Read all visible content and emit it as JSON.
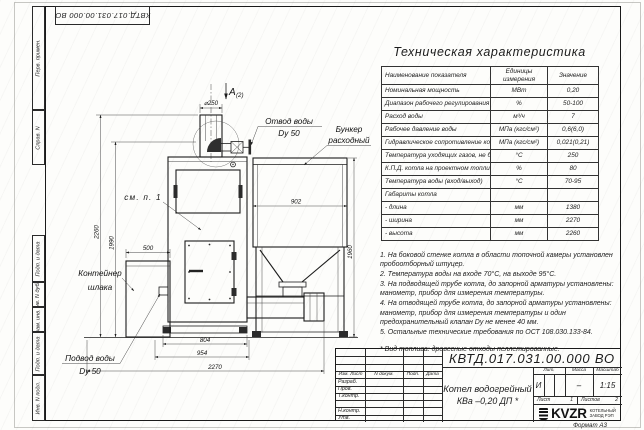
{
  "sheet": {
    "doc_number": "КВТД.017.031.00.000  ВО",
    "format_label": "Формат А3"
  },
  "margin_labels": [
    "Перв. примен.",
    "Справ. N",
    "Подп. и дата",
    "Инв. N дубл.",
    "Взам. инв. N",
    "Подп. и дата",
    "Инв. N подл."
  ],
  "spec_table": {
    "title": "Техническая характеристика",
    "col_name": "Наименование показателя",
    "col_units": "Единицы измерения",
    "col_value": "Значение",
    "rows": [
      {
        "name": "Номинальная мощность",
        "units": "МВт",
        "value": "0,20"
      },
      {
        "name": "Диапазон рабочего регулирования",
        "units": "%",
        "value": "50-100"
      },
      {
        "name": "Расход воды",
        "units": "м³/ч",
        "value": "7"
      },
      {
        "name": "Рабочее давление воды",
        "units": "МПа (кгс/см²)",
        "value": "0,6(6,0)"
      },
      {
        "name": "Гидравлическое сопротивление котла",
        "units": "МПа (кгс/см²)",
        "value": "0,021(0,21)"
      },
      {
        "name": "Температура уходящих газов, не более",
        "units": "°С",
        "value": "250"
      },
      {
        "name": "К.П.Д. котла на проектном топливе",
        "units": "%",
        "value": "80"
      },
      {
        "name": "Температура воды (вход/выход)",
        "units": "°С",
        "value": "70-95"
      },
      {
        "name": "Габариты котла",
        "units": "",
        "value": ""
      },
      {
        "name": "- длина",
        "units": "мм",
        "value": "1380"
      },
      {
        "name": "- ширина",
        "units": "мм",
        "value": "2270"
      },
      {
        "name": "- высота",
        "units": "мм",
        "value": "2260"
      }
    ]
  },
  "notes": {
    "items": [
      "1. На боковой стенке котла в области топочной камеры установлен пробоотборный штуцер.",
      "2. Температура воды на входе 70°С, на выходе 95°С.",
      "3. На подводящей трубе котла, до запорной арматуры установлены: манометр, прибор для измерения температуры.",
      "4. На отводящей трубе котла, до запорной арматуры установлены: манометр, прибор для измерения температуры и один предохранительный клапан Dу не менее 40 мм.",
      "5. Остальные технические требования по ОСТ 108.030.133-84."
    ],
    "fuel_note": "* Вид топлива: древесные отходы пеллетированные."
  },
  "title_block": {
    "doc_number": "КВТД.017.031.00.000  ВО",
    "product_line1": "Котел водогрейный",
    "product_line2": "КВа –0,20  ДП *",
    "col_izm": "Изм. Лист",
    "col_doc": "N докум.",
    "col_sign": "Подп.",
    "col_date": "Дата",
    "row_razrab": "Разраб.",
    "row_prov": "Пров.",
    "row_tkontr": "Т.контр.",
    "row_nkontr": "Н.контр.",
    "row_utv": "Утв.",
    "lit_label": "Лит.",
    "mass_label": "Масса",
    "scale_label": "Масштаб",
    "lit_value": "И",
    "mass_value": "–",
    "scale_value": "1:15",
    "sheet_label": "Лист",
    "sheet_value": "1",
    "sheets_label": "Листов",
    "sheets_value": "2",
    "company_name": "KVZR",
    "company_sub1": "КОТЕЛЬНЫЙ",
    "company_sub2": "ЗАВОД РЭП"
  },
  "drawing": {
    "view_label": "А",
    "view_sub": "(2)",
    "dia": "⌀250",
    "dim_500": "500",
    "dim_902": "902",
    "dim_1960": "1960",
    "dim_2260": "2260",
    "dim_1990": "1990",
    "dim_804": "804",
    "dim_954": "954",
    "dim_2270": "2270",
    "label_outlet1": "Отвод воды",
    "label_outlet2": "Dy 50",
    "label_bunker1": "Бункер",
    "label_bunker2": "расходный",
    "label_see": "см. п. 1",
    "label_container1": "Контейнер",
    "label_container2": "шлака",
    "label_inlet1": "Подвод воды",
    "label_inlet2": "Dy 50"
  }
}
